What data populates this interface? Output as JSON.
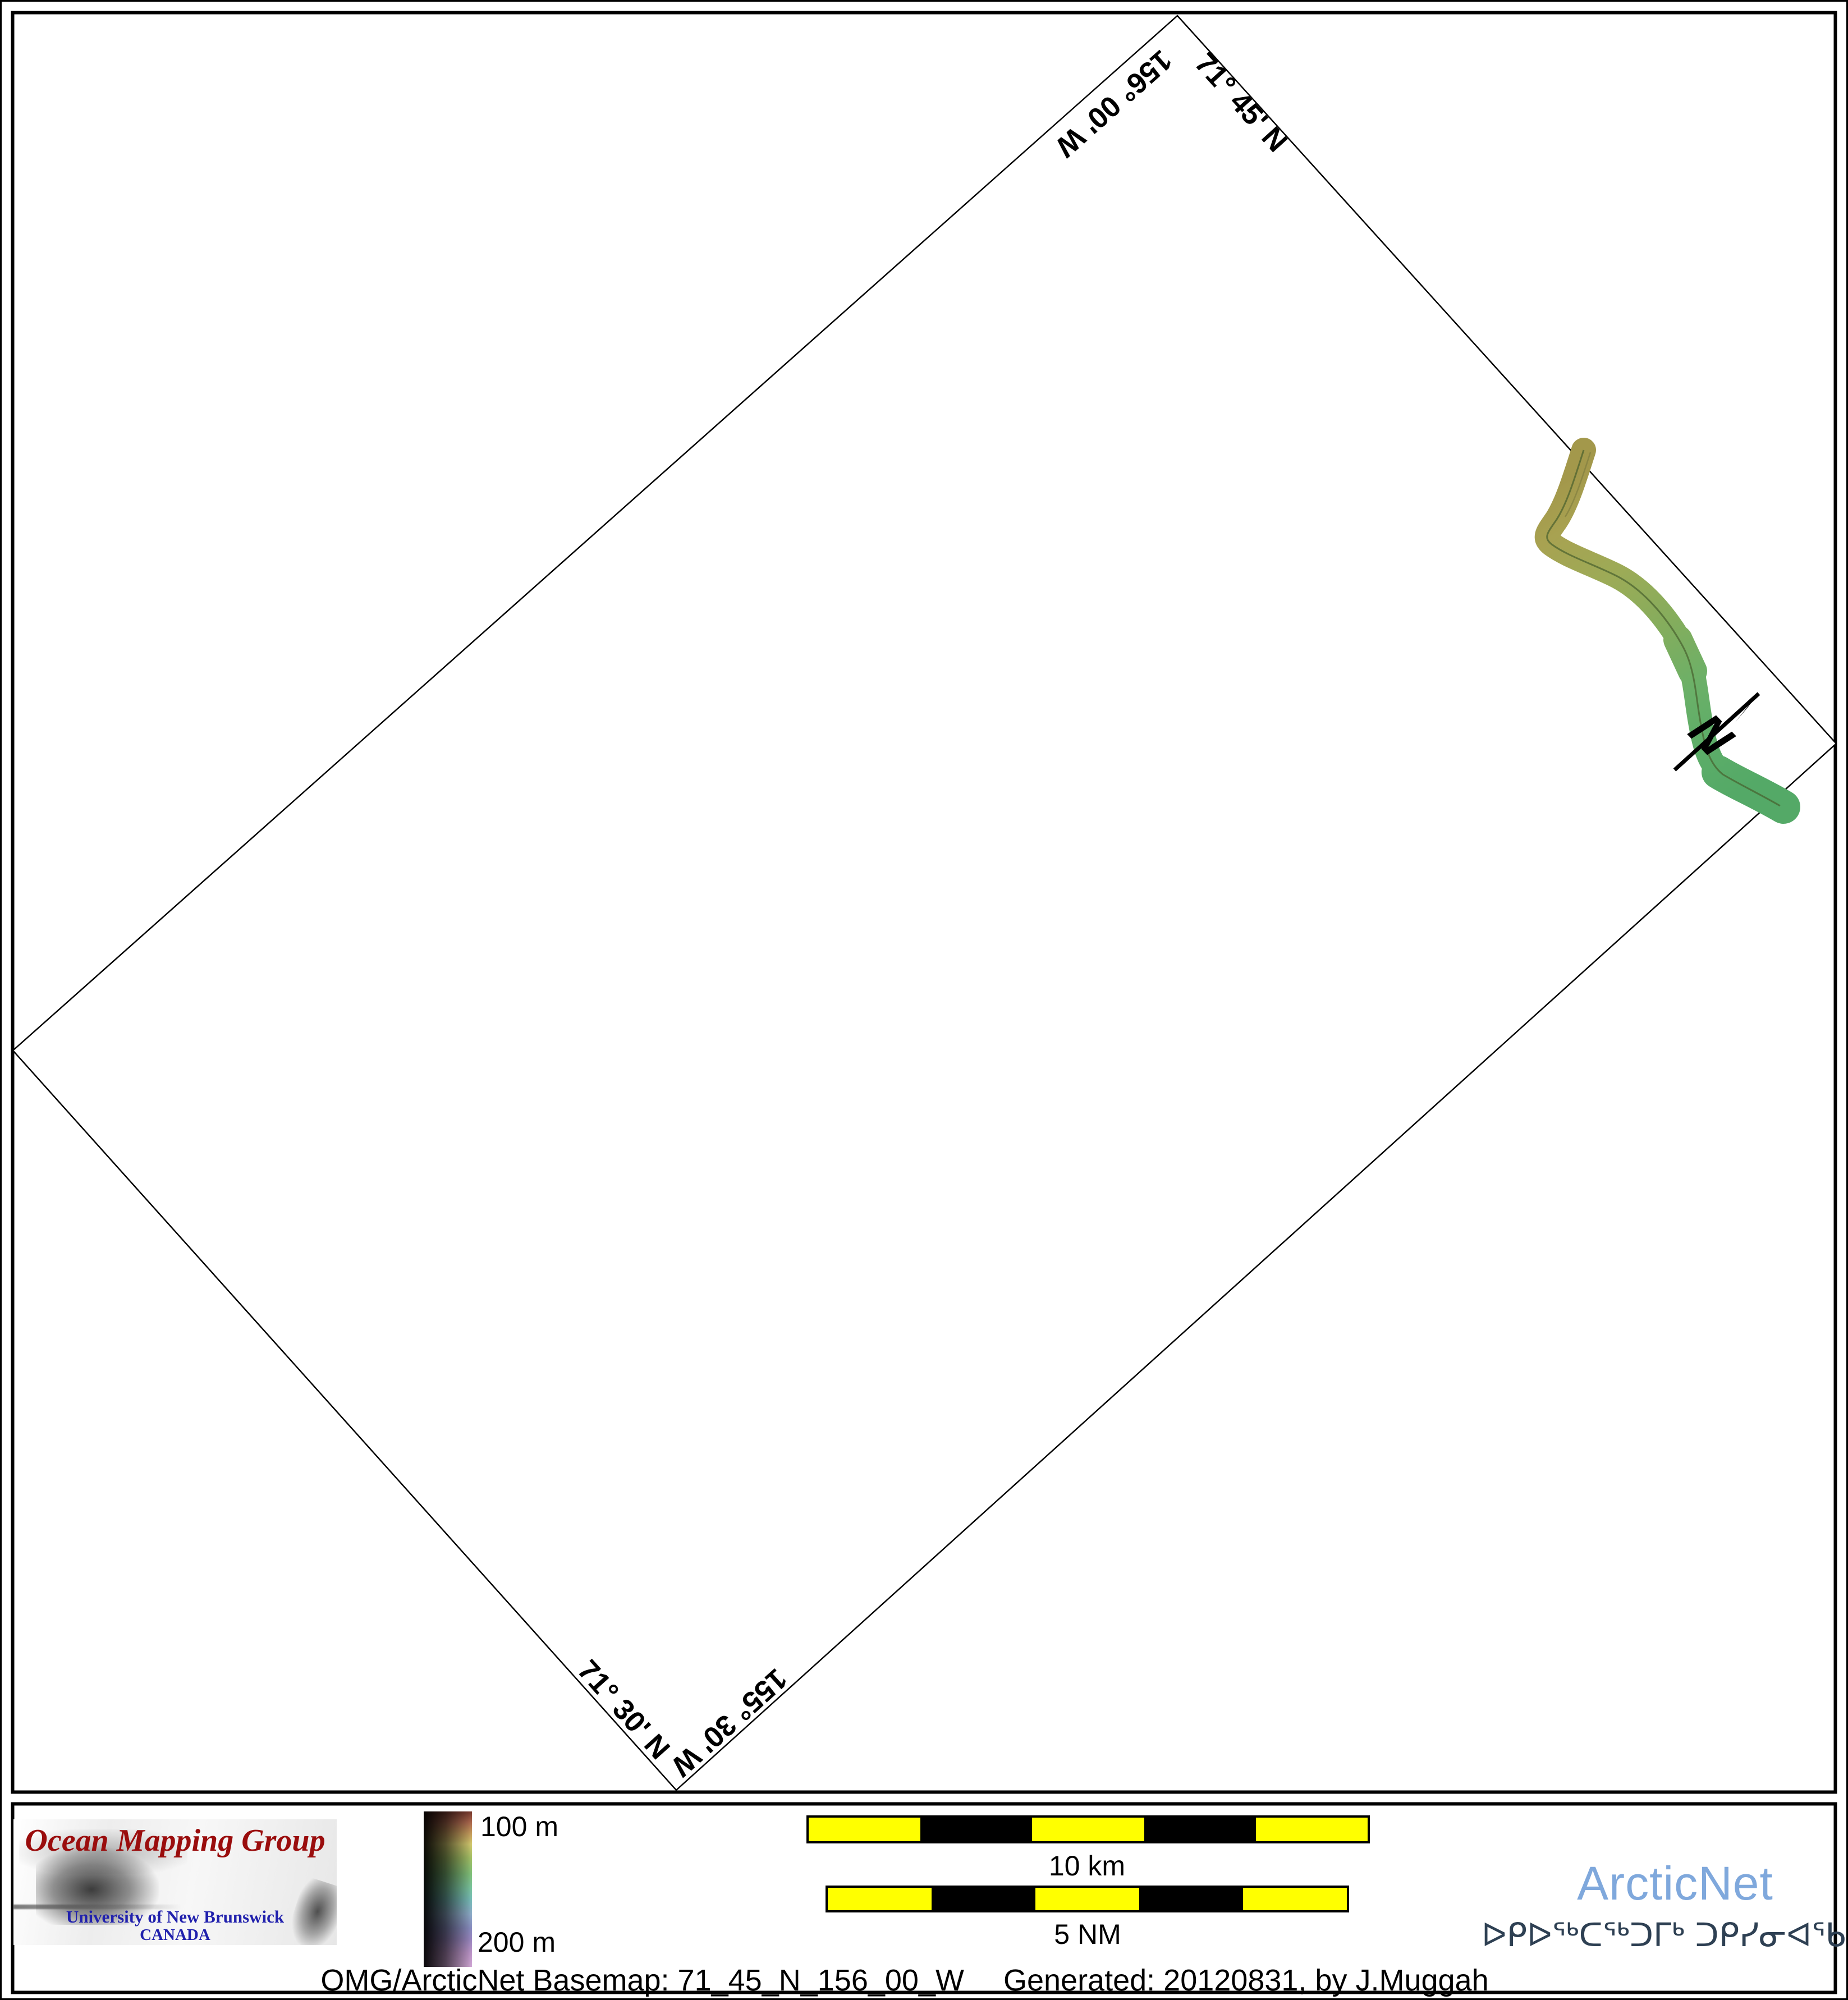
{
  "page": {
    "background": "#ffffff",
    "border_color": "#000000"
  },
  "map": {
    "graticule_labels": [
      {
        "id": "lon-top",
        "text": "156° 00' W"
      },
      {
        "id": "lat-top",
        "text": "71° 45' N"
      },
      {
        "id": "lat-bottom",
        "text": "71° 30' N"
      },
      {
        "id": "lon-bottom",
        "text": "155° 30' W"
      }
    ],
    "north_arrow_label": "N",
    "swath_colors": {
      "shallow": "#a3984b",
      "mid": "#83ad5d",
      "deep": "#54a967"
    }
  },
  "legend": {
    "omg": {
      "title": "Ocean Mapping Group",
      "university": "University of New Brunswick",
      "country": "CANADA",
      "title_color": "#9a0d0d",
      "text_color": "#2121ad"
    },
    "colorbar": {
      "top_label": "100 m",
      "bottom_label": "200 m"
    },
    "scalebars": {
      "km_label": "10 km",
      "nm_label": "5 NM",
      "stripe_colors": [
        "#ffff00",
        "#000000"
      ]
    },
    "arcticnet": {
      "name": "ArcticNet",
      "syllabics": "ᐅᑭᐅᖅᑕᖅᑐᒥᒃ ᑐᑭᓯᓂᐊᖃᑎᒌᑦ",
      "name_color": "#7fa8dc",
      "syllabics_color": "#2e4053"
    },
    "caption_left": "OMG/ArcticNet Basemap: 71_45_N_156_00_W",
    "caption_right": "Generated: 20120831, by J.Muggah"
  }
}
